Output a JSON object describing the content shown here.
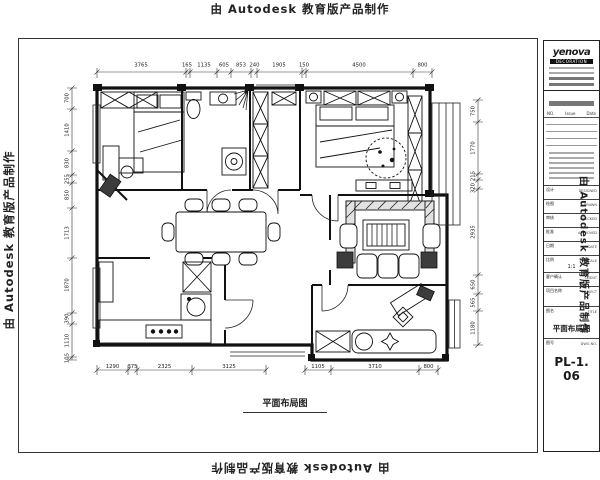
{
  "watermark": {
    "text": "由 Autodesk 教育版产品制作"
  },
  "plan": {
    "caption": "平面布局图"
  },
  "title_block": {
    "logo": "yenova",
    "logo_sub": "DECORATION",
    "table_header": {
      "no": "NO.",
      "issue": "Issue",
      "date": "Date"
    },
    "rows": [
      {
        "label": "设计",
        "en": "DESIGNED"
      },
      {
        "label": "绘图",
        "en": "DRAWN"
      },
      {
        "label": "审核",
        "en": "CHECKED"
      },
      {
        "label": "批准",
        "en": "APPROVED"
      },
      {
        "label": "日期",
        "en": "DATE"
      },
      {
        "label": "比例",
        "en": "SCALE",
        "value": "1:1"
      },
      {
        "label": "客户确认",
        "en": "CLIENT"
      },
      {
        "label": "项目名称",
        "en": "PROJECT"
      }
    ],
    "title_row": {
      "label": "图名",
      "en": "TITLE",
      "value": "平面布局图"
    },
    "dwg_row": {
      "label": "图号",
      "en": "DWG NO.",
      "value": "PL-1. 06"
    }
  },
  "dims": {
    "top": [
      "3765",
      "165",
      "1135",
      "605",
      "853",
      "240",
      "1905",
      "150",
      "4500",
      "800"
    ],
    "left": [
      "700",
      "1410",
      "830",
      "255",
      "850",
      "1713",
      "1870",
      "390",
      "1110",
      "105"
    ],
    "right": [
      "750",
      "1770",
      "215",
      "320",
      "2935",
      "650",
      "565",
      "1180"
    ],
    "bottom": [
      "1290",
      "375",
      "2325",
      "3125",
      "1105",
      "3710",
      "800"
    ]
  }
}
